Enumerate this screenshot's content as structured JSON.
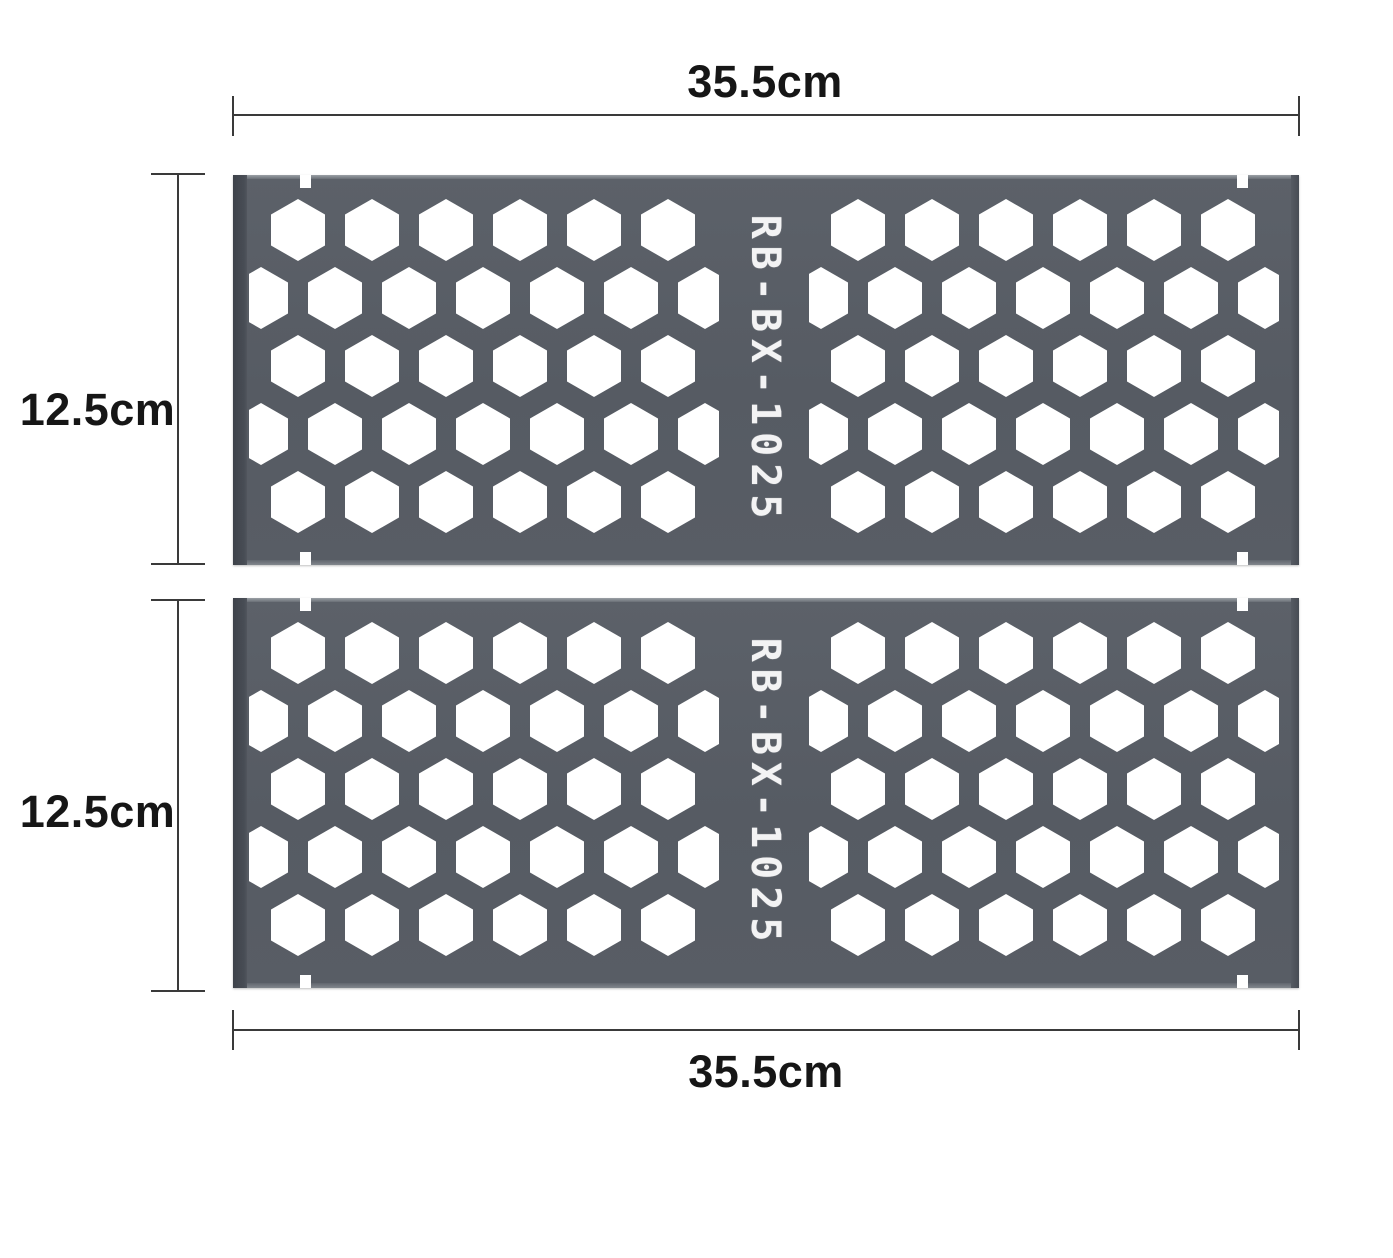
{
  "figure": {
    "background_color": "#ffffff",
    "dimension_line_color": "#3a3a3a",
    "dimension_text_color": "#161616"
  },
  "dimensions": {
    "top_width": {
      "label": "35.5cm"
    },
    "bottom_width": {
      "label": "35.5cm"
    },
    "panel1_height": {
      "label": "12.5cm"
    },
    "panel2_height": {
      "label": "12.5cm"
    }
  },
  "panels": [
    {
      "model": "RB-BX-1025"
    },
    {
      "model": "RB-BX-1025"
    }
  ],
  "panel_style": {
    "body_color": "#575c64",
    "left_fold_color": "#43474e",
    "top_lip_color": "#9ba0a6",
    "hole_color": "#ffffff",
    "model_text_color": "#f3f3f4"
  }
}
